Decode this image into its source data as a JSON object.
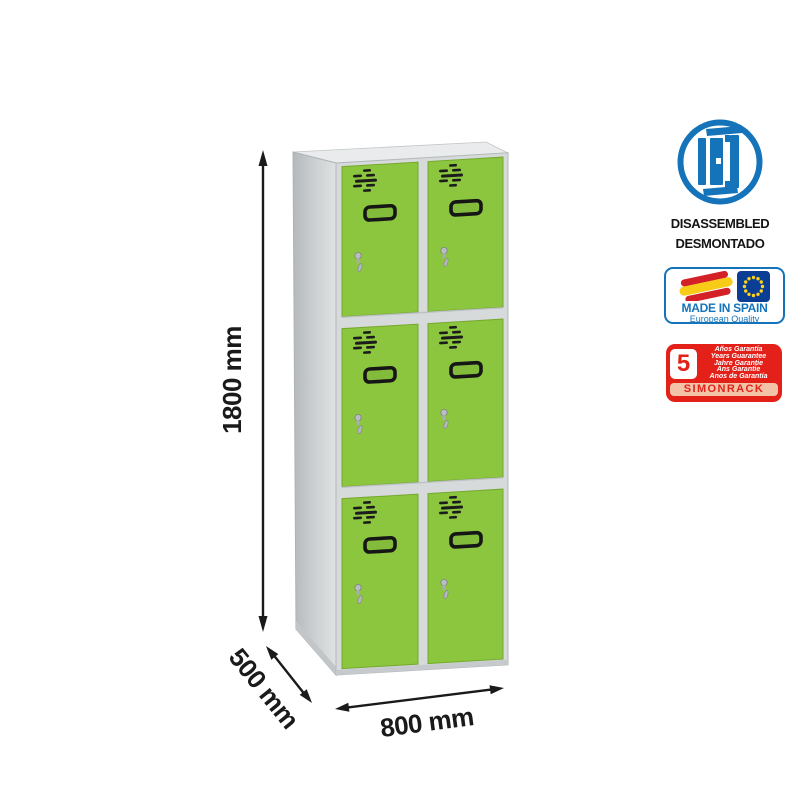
{
  "page": {
    "description": "Product image of a grey metal locker with six green doors, dimension arrows and certification badges"
  },
  "locker": {
    "name": "locker-cabinet",
    "columns": 2,
    "rows": 3,
    "door_count": 6,
    "door_color_name": "green",
    "body_color_name": "grey"
  },
  "dimensions": {
    "height_label": "1800 mm",
    "depth_label": "500 mm",
    "width_label": "800 mm"
  },
  "badges": {
    "disassembled": {
      "icon": "flat-pack-panels-icon",
      "line1": "DISASSEMBLED",
      "line2": "DESMONTADO"
    },
    "made_in_spain": {
      "icons": [
        "spain-flag-icon",
        "eu-flag-icon"
      ],
      "title": "MADE IN SPAIN",
      "subtitle": "European Quality"
    },
    "guarantee": {
      "number": "5",
      "lines": [
        "Años Garantía",
        "Years Guarantee",
        "Jahre Garantie",
        "Ans Garantie",
        "Anos de Garantía"
      ],
      "brand": "SIMONRACK"
    }
  },
  "colors": {
    "door_green": "#8cc63e",
    "frame_grey": "#d7dadb",
    "accent_blue": "#1573ba",
    "eu_blue": "#0a3d94",
    "star_yellow": "#ffd21e",
    "spain_red": "#d42027",
    "spain_yellow": "#f8cb17",
    "badge_red": "#e32119",
    "salmon": "#f2c3a7",
    "dim_black": "#1a1a1a"
  }
}
